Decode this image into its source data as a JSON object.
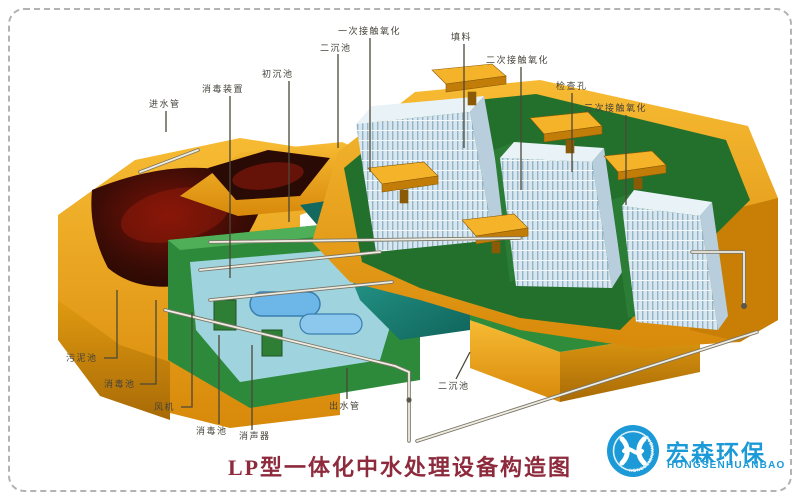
{
  "title": {
    "text": "LP型一体化中水处理设备构造图",
    "color": "#8d2a3c"
  },
  "labels": {
    "inlet_pipe": "进水管",
    "disinfection_device": "消毒装置",
    "primary_sedimentation_tank": "初沉池",
    "secondary_sedimentation_tank_top": "二沉池",
    "first_contact_oxidation": "一次接触氧化",
    "packing_media": "填料",
    "second_contact_oxidation": "二次接触氧化",
    "inspection_hole": "检查孔",
    "third_contact_oxidation": "三次接触氧化",
    "sludge_tank": "污泥池",
    "disinfection_tank_left": "消毒池",
    "blower": "风机",
    "disinfection_tank_bottom": "消毒池",
    "silencer": "消声器",
    "outlet_pipe": "出水管",
    "secondary_sedimentation_tank_bottom": "二沉池"
  },
  "logo": {
    "name_cn": "宏森环保",
    "name_en": "HONGSENHUANBAO",
    "ring_text": "HONGSENHUANBAO",
    "brand_color": "#1b9ad7"
  },
  "colors": {
    "shell_orange": "#e89b10",
    "shell_orange_light": "#f6b62a",
    "shell_orange_dark": "#b87607",
    "basin_green": "#2d8a3a",
    "basin_green_dark": "#1f6329",
    "water_teal": "#14695f",
    "water_teal_dark": "#0f5c54",
    "interior_maroon": "#230a06",
    "interior_red": "#9c1c0c",
    "packing_blue": "#d8e7ef",
    "packing_stripe": "#93b3c6",
    "pipe_light": "#efece2",
    "leader_line": "#4a4838",
    "border_dash": "#b3b3b3"
  }
}
